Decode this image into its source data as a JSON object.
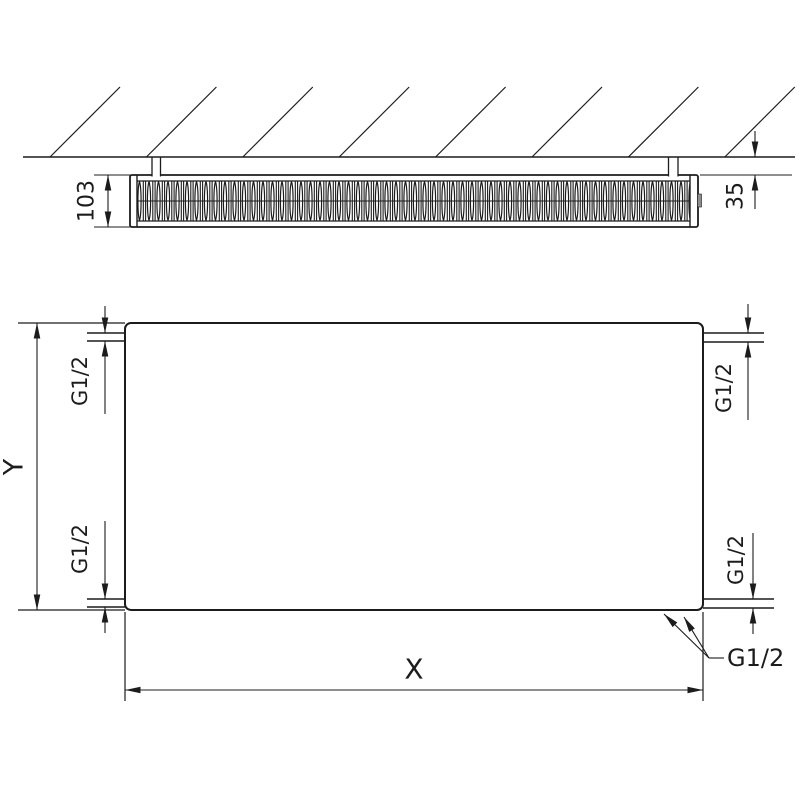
{
  "colors": {
    "line": "#1c1c1c",
    "background": "#ffffff",
    "bracket_tab": "#8c8c8c"
  },
  "top_view": {
    "depth_dimension": "103",
    "wall_distance_dimension": "35"
  },
  "front_view": {
    "width_dimension": "X",
    "height_dimension": "Y",
    "connections": {
      "top_left": "G1/2",
      "top_right": "G1/2",
      "bottom_left": "G1/2",
      "bottom_right": "G1/2",
      "bottom_callout": "G1/2"
    }
  }
}
